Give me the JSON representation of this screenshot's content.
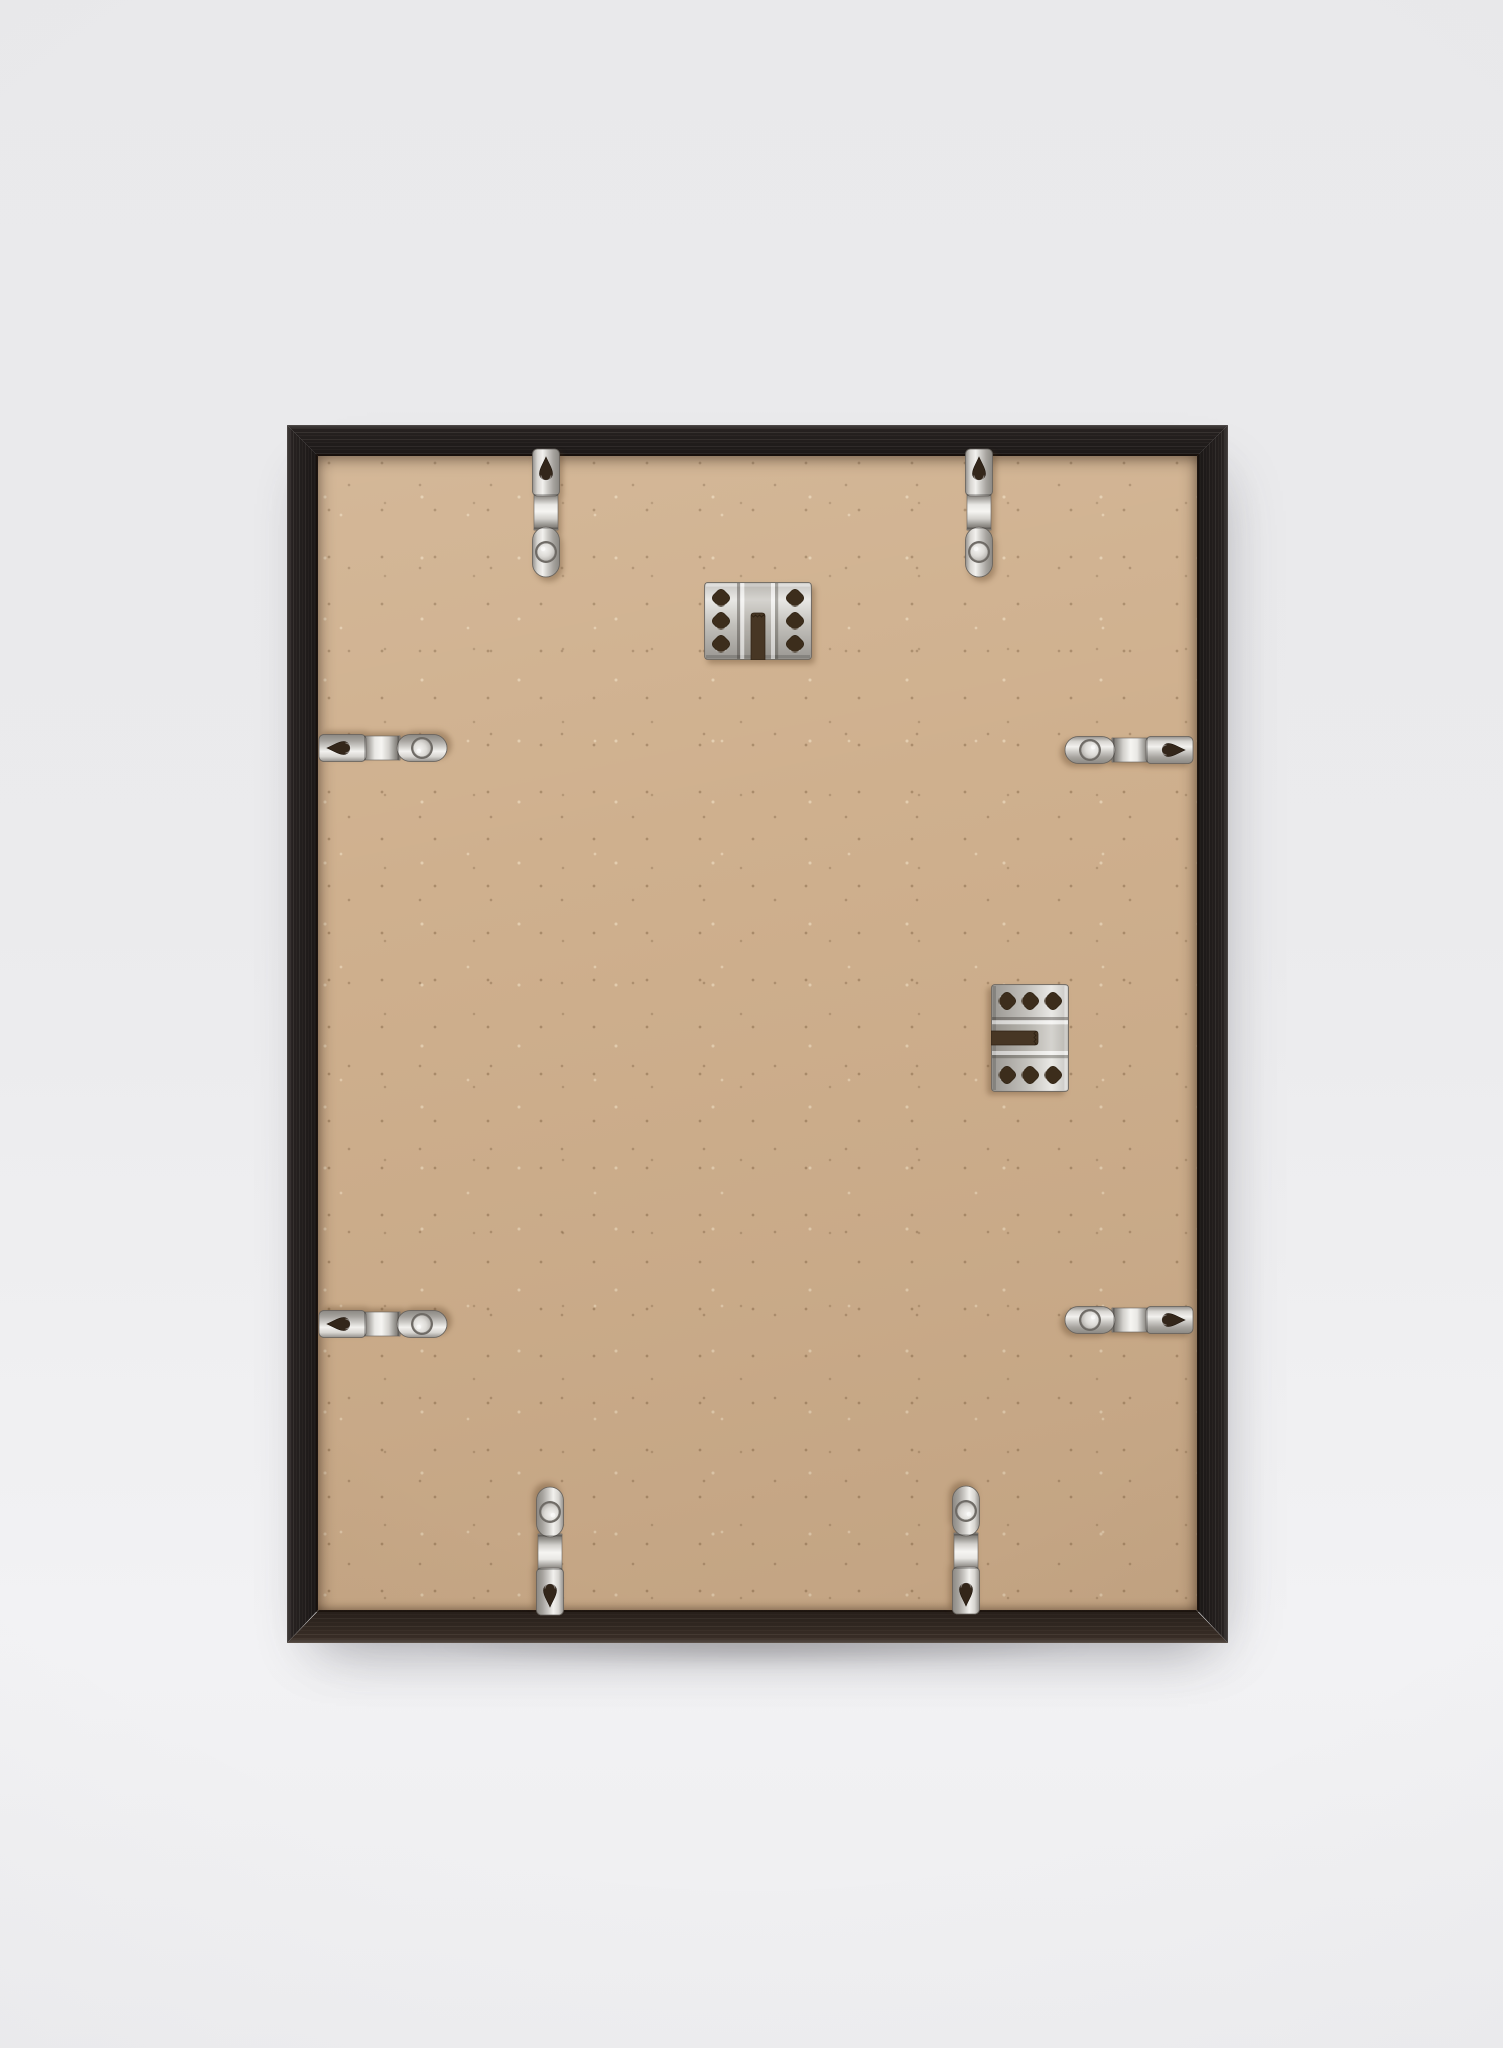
{
  "scene": {
    "subject": "back-of-black-wooden-picture-frame",
    "description": "Rear view of an empty black ash wood picture frame leaning against a plain light grey wall, showing a tan MDF backing board held by eight nickel spring clips and fitted with two nickel sawtooth-style hanger plates."
  },
  "palette": {
    "bg-top": "#e9e9eb",
    "bg-mid": "#ebebed",
    "bg-low": "#f2f2f4",
    "wood": "#262120",
    "wood-warm": "#382d26",
    "board": "#cfb08e",
    "board-dark": "#b28e68",
    "board-light": "#e9d2b0",
    "metal": "#c9c7c3",
    "metal-bright": "#f2f1ee",
    "metal-dark": "#7d7a75",
    "hole-shadow": "#3c2d1c"
  },
  "frame": {
    "outer": {
      "x": 287,
      "y": 425,
      "width": 941,
      "height": 1218
    },
    "rail_thickness": 31,
    "bottom_rail_thickness": 33,
    "material": "black-stained ash wood, visible grain",
    "backing": "plain kraft/MDF board with speckle texture, no labels or stickers"
  },
  "hardware": {
    "clip_count": 8,
    "hanger_count": 2,
    "flexi_clips": [
      {
        "name": "spring-clip-top-left",
        "edge": "top",
        "cx": 546,
        "cy": 513,
        "rotation": 0
      },
      {
        "name": "spring-clip-top-right",
        "edge": "top",
        "cx": 979,
        "cy": 513,
        "rotation": 0
      },
      {
        "name": "spring-clip-left-upper",
        "edge": "left",
        "cx": 383,
        "cy": 748,
        "rotation": -90
      },
      {
        "name": "spring-clip-right-upper",
        "edge": "right",
        "cx": 1129,
        "cy": 750,
        "rotation": 90
      },
      {
        "name": "spring-clip-left-lower",
        "edge": "left",
        "cx": 383,
        "cy": 1324,
        "rotation": -90
      },
      {
        "name": "spring-clip-right-lower",
        "edge": "right",
        "cx": 1129,
        "cy": 1320,
        "rotation": 90
      },
      {
        "name": "spring-clip-bottom-left",
        "edge": "bottom",
        "cx": 550,
        "cy": 1551,
        "rotation": 180
      },
      {
        "name": "spring-clip-bottom-right",
        "edge": "bottom",
        "cx": 966,
        "cy": 1550,
        "rotation": 180
      }
    ],
    "hangers": [
      {
        "name": "hanger-plate-top-center",
        "cx": 758,
        "cy": 621,
        "rotation": 0,
        "notch_opens": "down"
      },
      {
        "name": "hanger-plate-right-middle",
        "cx": 1030,
        "cy": 1038,
        "rotation": 90,
        "notch_opens": "left"
      }
    ]
  }
}
